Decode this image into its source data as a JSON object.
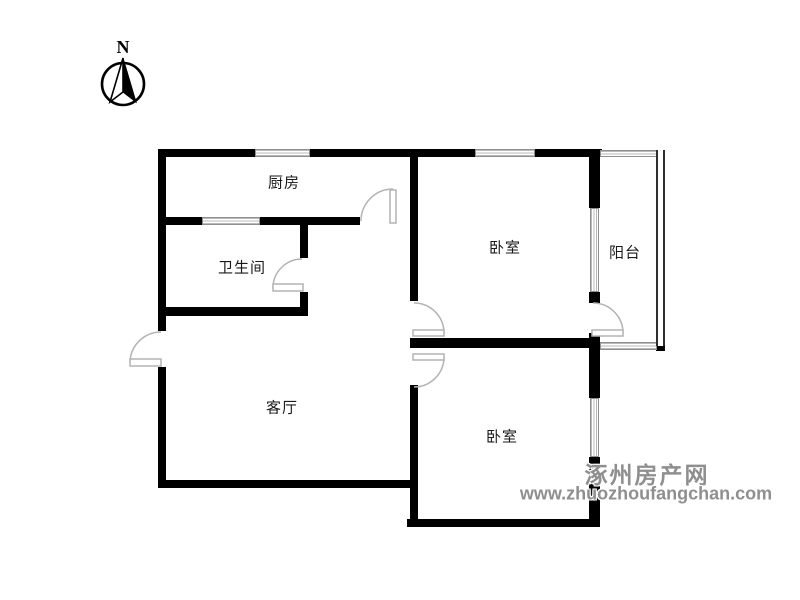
{
  "compass": {
    "north_label": "N"
  },
  "rooms": {
    "kitchen": {
      "label": "厨房"
    },
    "bathroom": {
      "label": "卫生间"
    },
    "bedroom_north": {
      "label": "卧室"
    },
    "balcony": {
      "label": "阳台"
    },
    "living_room": {
      "label": "客厅"
    },
    "bedroom_south": {
      "label": "卧室"
    }
  },
  "watermark": {
    "site_name": "涿州房产网",
    "site_url": "www.zhuozhoufangchan.com"
  },
  "colors": {
    "wall": "#000000",
    "door_stroke": "#b3b3b3",
    "window_line": "#b9b9b9",
    "watermark_text": "#8f8f8f"
  }
}
